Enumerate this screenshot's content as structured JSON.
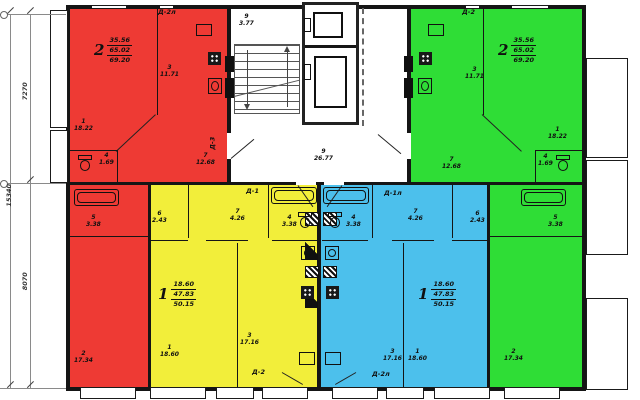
{
  "colors": {
    "red": "#ee3a34",
    "green": "#2fdd36",
    "yellow": "#f2ee3a",
    "blue": "#4cc0ec",
    "wall": "#151515"
  },
  "dimensions": {
    "left_top": "7270",
    "left_bottom": "8070",
    "left_total": "15340"
  },
  "stairwell": {
    "stairs": {
      "number": "9",
      "area": "3.77"
    },
    "hall": {
      "number": "9",
      "area": "26.77"
    },
    "door_mark": "Д-3"
  },
  "apartments": {
    "red": {
      "type": "2",
      "area_living": "35.56",
      "area_total": "65.02",
      "area_overall": "69.20",
      "door_top": "Д-2л",
      "rooms": {
        "r1": {
          "number": "1",
          "area": "18.22"
        },
        "r2": {
          "number": "2",
          "area": "17.34"
        },
        "r3": {
          "number": "3",
          "area": "11.71"
        },
        "r4": {
          "number": "4",
          "area": "1.69"
        },
        "r5": {
          "number": "5",
          "area": "3.38"
        },
        "r7": {
          "number": "7",
          "area": "12.68"
        }
      }
    },
    "green": {
      "type": "2",
      "area_living": "35.56",
      "area_total": "65.02",
      "area_overall": "69.20",
      "door_top": "Д-2",
      "rooms": {
        "r1": {
          "number": "1",
          "area": "18.22"
        },
        "r2": {
          "number": "2",
          "area": "17.34"
        },
        "r3": {
          "number": "3",
          "area": "11.71"
        },
        "r4": {
          "number": "4",
          "area": "1.69"
        },
        "r5": {
          "number": "5",
          "area": "3.38"
        },
        "r7": {
          "number": "7",
          "area": "12.68"
        }
      }
    },
    "yellow": {
      "type": "1",
      "area_living": "18.60",
      "area_total": "47.83",
      "area_overall": "50.15",
      "door_top": "Д-1",
      "door_bottom": "Д-2",
      "rooms": {
        "r1": {
          "number": "1",
          "area": "18.60"
        },
        "r3": {
          "number": "3",
          "area": "17.16"
        },
        "r4": {
          "number": "4",
          "area": "3.38"
        },
        "r6": {
          "number": "6",
          "area": "2.43"
        },
        "r7": {
          "number": "7",
          "area": "4.26"
        }
      }
    },
    "blue": {
      "type": "1",
      "area_living": "18.60",
      "area_total": "47.83",
      "area_overall": "50.15",
      "door_top": "Д-1л",
      "door_bottom": "Д-2л",
      "rooms": {
        "r1": {
          "number": "1",
          "area": "18.60"
        },
        "r3": {
          "number": "3",
          "area": "17.16"
        },
        "r4": {
          "number": "4",
          "area": "3.38"
        },
        "r6": {
          "number": "6",
          "area": "2.43"
        },
        "r7": {
          "number": "7",
          "area": "4.26"
        }
      }
    }
  }
}
